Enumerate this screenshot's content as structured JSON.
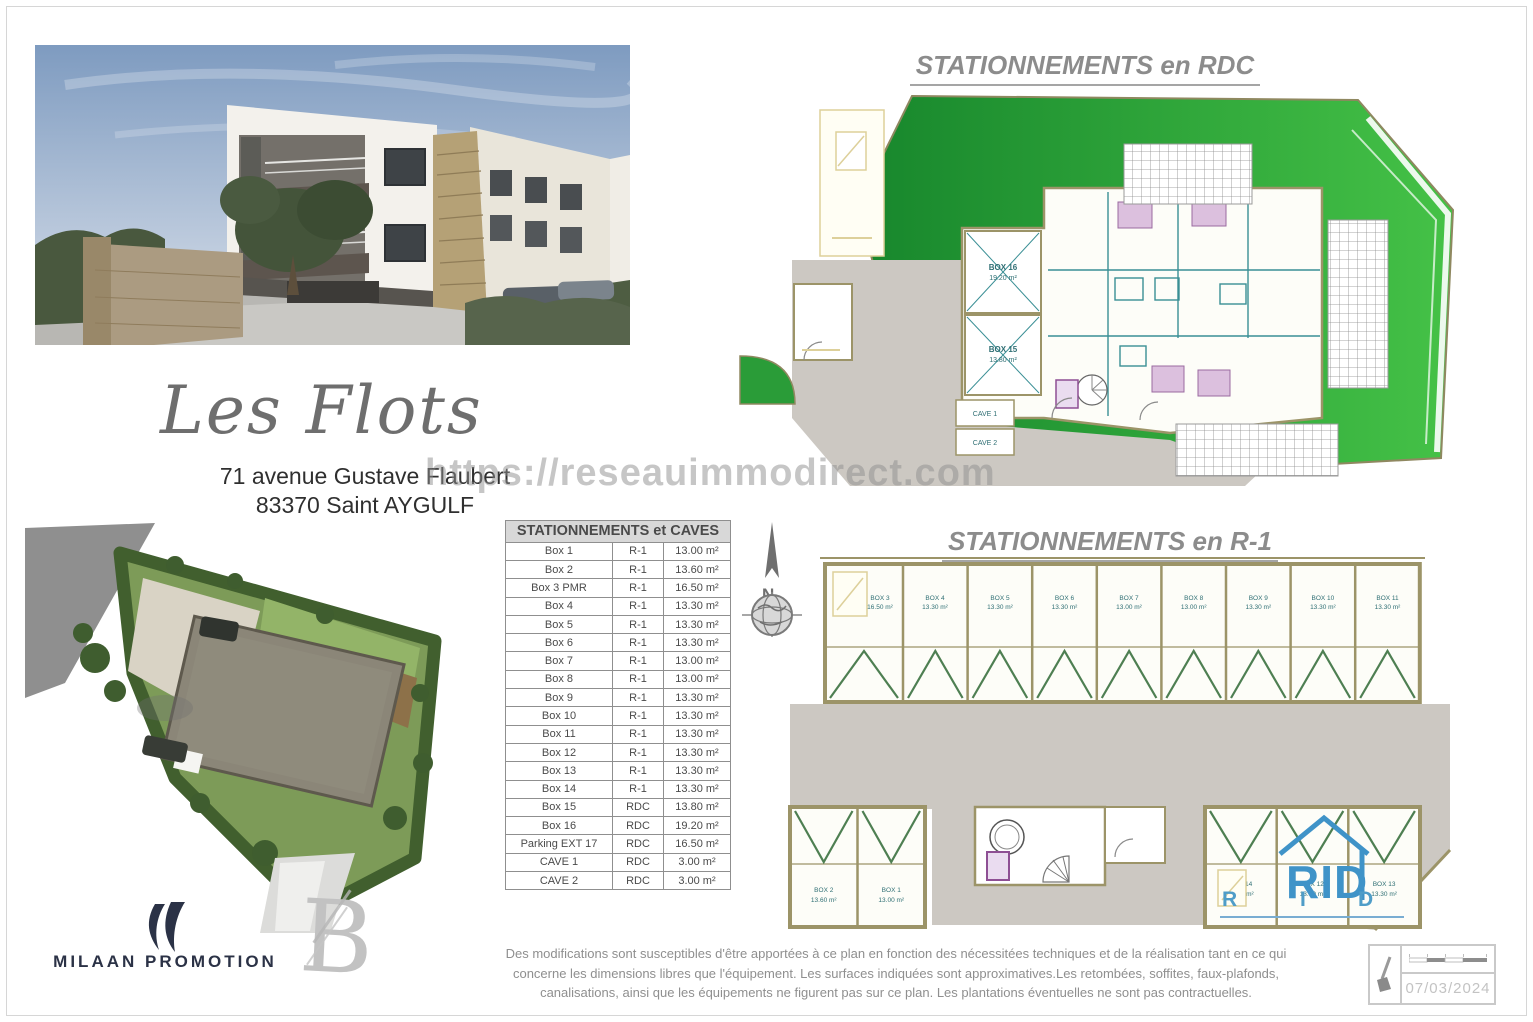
{
  "header": {
    "project_title": "Les Flots",
    "address_line1": "71 avenue Gustave Flaubert",
    "address_line2": "83370 Saint AYGULF"
  },
  "watermark": "https://reseauimmodirect.com",
  "plan_rdc": {
    "title": "STATIONNEMENTS en RDC",
    "labels": {
      "box16_name": "BOX 16",
      "box16_area": "19.20 m²",
      "box15_name": "BOX 15",
      "box15_area": "13.80 m²",
      "cave1": "CAVE 1",
      "cave2": "CAVE 2"
    }
  },
  "plan_r1": {
    "title": "STATIONNEMENTS en R-1",
    "top_boxes": [
      {
        "name": "BOX 3",
        "area": "16.50 m²"
      },
      {
        "name": "BOX 4",
        "area": "13.30 m²"
      },
      {
        "name": "BOX 5",
        "area": "13.30 m²"
      },
      {
        "name": "BOX 6",
        "area": "13.30 m²"
      },
      {
        "name": "BOX 7",
        "area": "13.00 m²"
      },
      {
        "name": "BOX 8",
        "area": "13.00 m²"
      },
      {
        "name": "BOX 9",
        "area": "13.30 m²"
      },
      {
        "name": "BOX 10",
        "area": "13.30 m²"
      },
      {
        "name": "BOX 11",
        "area": "13.30 m²"
      }
    ],
    "bottom_left_boxes": [
      {
        "name": "BOX 2",
        "area": "13.60 m²"
      },
      {
        "name": "BOX 1",
        "area": "13.00 m²"
      }
    ],
    "bottom_right_boxes": [
      {
        "name": "BOX 14",
        "area": "13.30 m²"
      },
      {
        "name": "BOX 12",
        "area": "13.30 m²"
      },
      {
        "name": "BOX 13",
        "area": "13.30 m²"
      }
    ]
  },
  "table": {
    "title": "STATIONNEMENTS et CAVES",
    "rows": [
      [
        "Box 1",
        "R-1",
        "13.00 m²"
      ],
      [
        "Box 2",
        "R-1",
        "13.60 m²"
      ],
      [
        "Box 3 PMR",
        "R-1",
        "16.50 m²"
      ],
      [
        "Box 4",
        "R-1",
        "13.30 m²"
      ],
      [
        "Box 5",
        "R-1",
        "13.30 m²"
      ],
      [
        "Box 6",
        "R-1",
        "13.30 m²"
      ],
      [
        "Box 7",
        "R-1",
        "13.00 m²"
      ],
      [
        "Box 8",
        "R-1",
        "13.00 m²"
      ],
      [
        "Box 9",
        "R-1",
        "13.30 m²"
      ],
      [
        "Box 10",
        "R-1",
        "13.30 m²"
      ],
      [
        "Box 11",
        "R-1",
        "13.30 m²"
      ],
      [
        "Box 12",
        "R-1",
        "13.30 m²"
      ],
      [
        "Box 13",
        "R-1",
        "13.30 m²"
      ],
      [
        "Box 14",
        "R-1",
        "13.30 m²"
      ],
      [
        "Box 15",
        "RDC",
        "13.80 m²"
      ],
      [
        "Box 16",
        "RDC",
        "19.20 m²"
      ],
      [
        "Parking EXT 17",
        "RDC",
        "16.50 m²"
      ],
      [
        "CAVE 1",
        "RDC",
        "3.00 m²"
      ],
      [
        "CAVE 2",
        "RDC",
        "3.00 m²"
      ]
    ]
  },
  "compass": {
    "north_label": "N"
  },
  "logos": {
    "developer": "MILAAN PROMOTION",
    "architect_letter": "B",
    "rid_monogram": "RID",
    "rid_r": "R",
    "rid_i": "I",
    "rid_d": "D"
  },
  "footer": {
    "disclaimer_line1": "Des modifications sont susceptibles d'être apportées à ce plan en fonction des nécessitées techniques et de la réalisation tant en ce qui",
    "disclaimer_line2": "concerne les dimensions libres que l'équipement.  Les surfaces indiquées sont approximatives.Les retombées, soffites, faux-plafonds,",
    "disclaimer_line3": "canalisations, ainsi que les équipements ne figurent pas sur ce plan. Les plantations éventuelles ne sont pas contractuelles.",
    "date": "07/03/2024"
  },
  "colors": {
    "lawn_green_dark": "#17862c",
    "lawn_green_bright": "#45c247",
    "wall_tan": "#9c9468",
    "room_teal": "#3a8f95",
    "accent_blue": "#3f93c8"
  }
}
